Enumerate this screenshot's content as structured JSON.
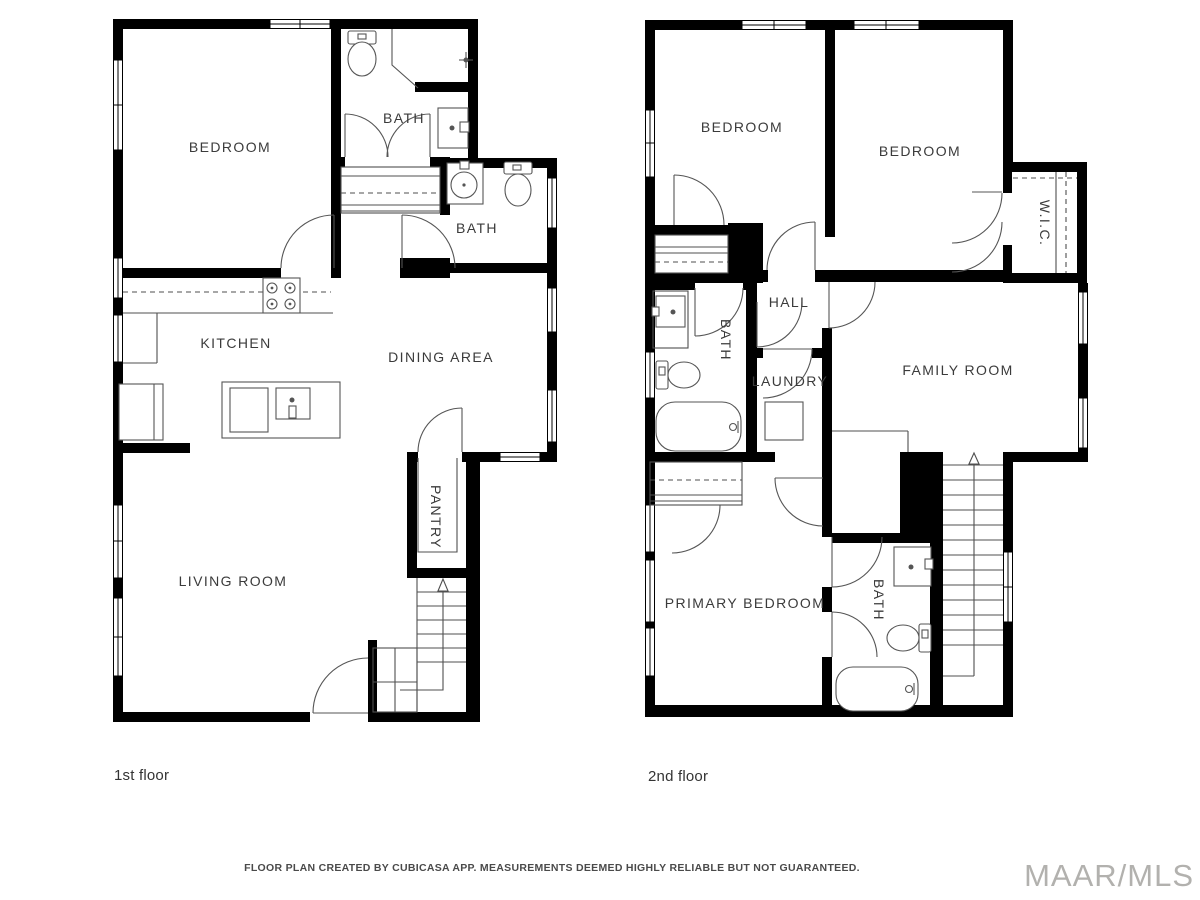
{
  "floors": {
    "floor1": {
      "caption": "1st floor",
      "rooms": {
        "bedroom": "BEDROOM",
        "bath_top": "BATH",
        "bath_right": "BATH",
        "kitchen": "KITCHEN",
        "dining": "DINING AREA",
        "pantry": "PANTRY",
        "living": "LIVING ROOM"
      }
    },
    "floor2": {
      "caption": "2nd floor",
      "rooms": {
        "bedroom_left": "BEDROOM",
        "bedroom_right": "BEDROOM",
        "wic": "W.I.C.",
        "hall": "HALL",
        "bath_mid": "BATH",
        "laundry": "LAUNDRY",
        "family": "FAMILY ROOM",
        "primary": "PRIMARY BEDROOM",
        "bath_bottom": "BATH"
      }
    }
  },
  "footer": {
    "disclaimer": "FLOOR PLAN CREATED BY CUBICASA APP. MEASUREMENTS DEEMED HIGHLY RELIABLE BUT NOT GUARANTEED."
  },
  "watermark": "MAAR/MLS",
  "colors": {
    "wall": "#000000",
    "line": "#4f4f4f",
    "text": "#3b3b3b",
    "watermark": "#b2b1ae"
  }
}
